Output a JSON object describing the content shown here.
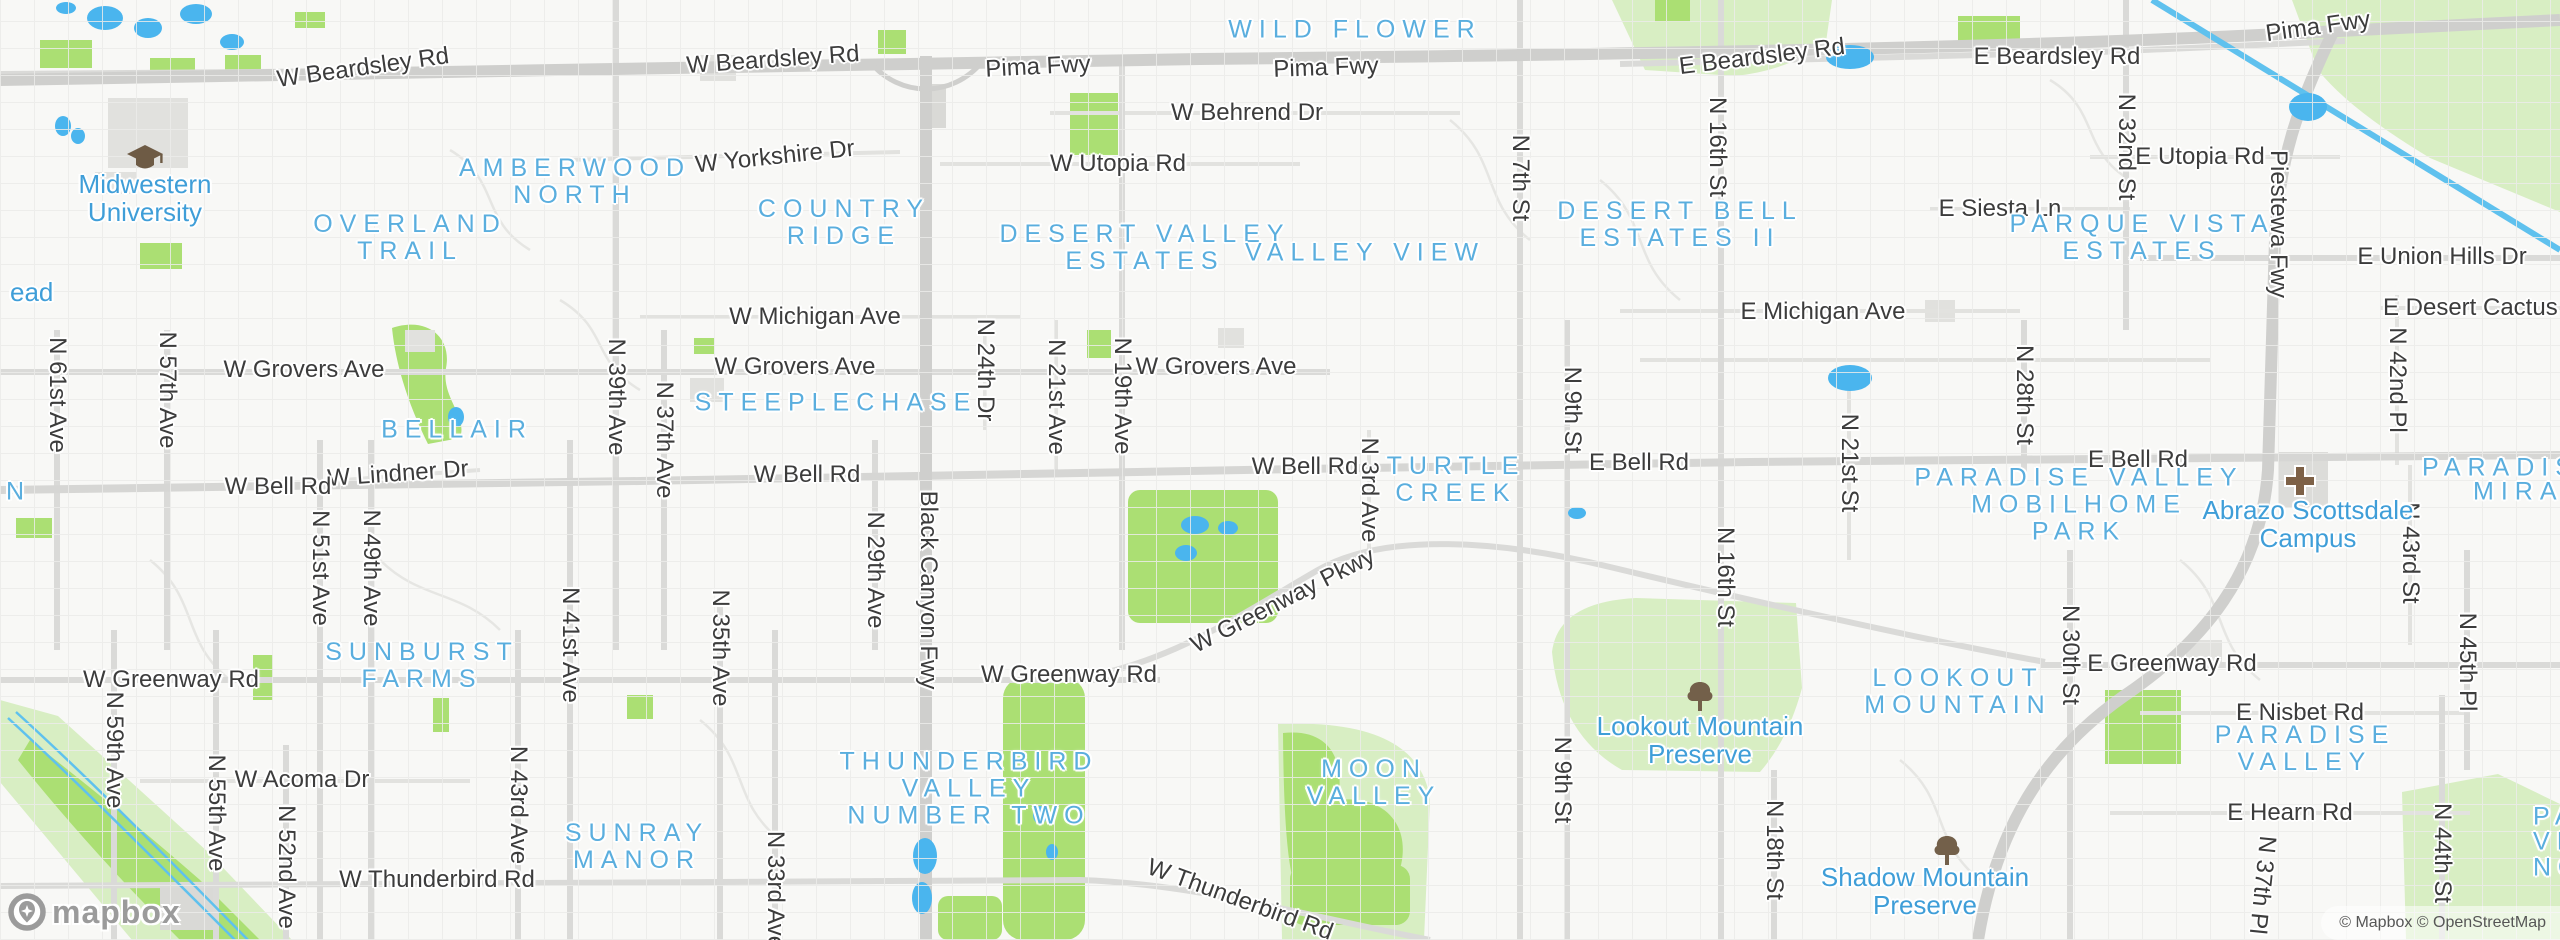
{
  "palette": {
    "land": "#f8f8f6",
    "park_bright": "#abdf73",
    "park_light": "#d8eec3",
    "water": "#4ab5ee",
    "canal": "#5fc1ee",
    "road_minor": "#e6e6e3",
    "road_arterial": "#dadad8",
    "road_freeway": "#cfcfcd",
    "building": "#e1e1de",
    "street_label": "#3c3c3c",
    "neighborhood_label": "#5aaede",
    "poi_label": "#3f9ed8",
    "icon_brown": "#73604a",
    "logo_gray": "#9b9b9b"
  },
  "street_labels": [
    {
      "text": "W Beardsley Rd",
      "x": 363,
      "y": 68,
      "rot": -8
    },
    {
      "text": "W Beardsley Rd",
      "x": 773,
      "y": 60,
      "rot": -4
    },
    {
      "text": "Pima Fwy",
      "x": 1038,
      "y": 67,
      "rot": -3
    },
    {
      "text": "Pima Fwy",
      "x": 1326,
      "y": 68,
      "rot": -2
    },
    {
      "text": "Pima Fwy",
      "x": 2318,
      "y": 27,
      "rot": -8
    },
    {
      "text": "E Beardsley Rd",
      "x": 1762,
      "y": 57,
      "rot": -7
    },
    {
      "text": "E Beardsley Rd",
      "x": 2057,
      "y": 57,
      "rot": 0
    },
    {
      "text": "W Behrend Dr",
      "x": 1247,
      "y": 113,
      "rot": 0
    },
    {
      "text": "W Yorkshire Dr",
      "x": 775,
      "y": 157,
      "rot": -6
    },
    {
      "text": "W Utopia Rd",
      "x": 1118,
      "y": 164,
      "rot": 0
    },
    {
      "text": "E Utopia Rd",
      "x": 2200,
      "y": 157,
      "rot": 0
    },
    {
      "text": "E Siesta Ln",
      "x": 2000,
      "y": 209,
      "rot": 0
    },
    {
      "text": "E Union Hills Dr",
      "x": 2442,
      "y": 257,
      "rot": 0
    },
    {
      "text": "E Desert Cactus St",
      "x": 2485,
      "y": 308,
      "rot": 0
    },
    {
      "text": "W Michigan Ave",
      "x": 815,
      "y": 317,
      "rot": 0
    },
    {
      "text": "E Michigan Ave",
      "x": 1823,
      "y": 312,
      "rot": 0
    },
    {
      "text": "W Grovers Ave",
      "x": 304,
      "y": 370,
      "rot": 0
    },
    {
      "text": "W Grovers Ave",
      "x": 795,
      "y": 367,
      "rot": 0
    },
    {
      "text": "W Grovers Ave",
      "x": 1216,
      "y": 367,
      "rot": 0
    },
    {
      "text": "W Lindner Dr",
      "x": 398,
      "y": 474,
      "rot": -4
    },
    {
      "text": "W Bell Rd",
      "x": 278,
      "y": 487,
      "rot": 0
    },
    {
      "text": "W Bell Rd",
      "x": 807,
      "y": 475,
      "rot": 0
    },
    {
      "text": "W Bell Rd",
      "x": 1305,
      "y": 467,
      "rot": 0
    },
    {
      "text": "E Bell Rd",
      "x": 1639,
      "y": 463,
      "rot": 0
    },
    {
      "text": "E Bell Rd",
      "x": 2138,
      "y": 460,
      "rot": 0
    },
    {
      "text": "W Greenway Pkwy",
      "x": 1283,
      "y": 601,
      "rot": -27
    },
    {
      "text": "W Greenway Rd",
      "x": 171,
      "y": 680,
      "rot": 0
    },
    {
      "text": "W Greenway Rd",
      "x": 1069,
      "y": 675,
      "rot": 0
    },
    {
      "text": "E Greenway Rd",
      "x": 2172,
      "y": 664,
      "rot": 0
    },
    {
      "text": "E Nisbet Rd",
      "x": 2300,
      "y": 713,
      "rot": 0
    },
    {
      "text": "W Acoma Dr",
      "x": 302,
      "y": 780,
      "rot": 0
    },
    {
      "text": "E Hearn Rd",
      "x": 2290,
      "y": 813,
      "rot": 0
    },
    {
      "text": "W Thunderbird Rd",
      "x": 437,
      "y": 880,
      "rot": 0
    },
    {
      "text": "W Thunderbird Rd",
      "x": 1240,
      "y": 900,
      "rot": 20
    }
  ],
  "vertical_street_labels": [
    {
      "text": "N 61st Ave",
      "x": 57,
      "y": 395
    },
    {
      "text": "N 57th Ave",
      "x": 167,
      "y": 390
    },
    {
      "text": "N 59th Ave",
      "x": 114,
      "y": 750
    },
    {
      "text": "N 55th Ave",
      "x": 216,
      "y": 813
    },
    {
      "text": "N 52nd Ave",
      "x": 286,
      "y": 867
    },
    {
      "text": "N 51st Ave",
      "x": 320,
      "y": 568
    },
    {
      "text": "N 49th Ave",
      "x": 371,
      "y": 568
    },
    {
      "text": "N 43rd Ave",
      "x": 518,
      "y": 805
    },
    {
      "text": "N 41st Ave",
      "x": 570,
      "y": 645
    },
    {
      "text": "N 39th Ave",
      "x": 616,
      "y": 397
    },
    {
      "text": "N 37th Ave",
      "x": 664,
      "y": 440
    },
    {
      "text": "N 35th Ave",
      "x": 720,
      "y": 648
    },
    {
      "text": "N 33rd Ave",
      "x": 775,
      "y": 890
    },
    {
      "text": "N 29th Ave",
      "x": 875,
      "y": 570
    },
    {
      "text": "Black Canyon Fwy",
      "x": 928,
      "y": 590
    },
    {
      "text": "N 24th Dr",
      "x": 985,
      "y": 370
    },
    {
      "text": "N 21st Ave",
      "x": 1056,
      "y": 397
    },
    {
      "text": "N 19th Ave",
      "x": 1122,
      "y": 396
    },
    {
      "text": "N 3rd Ave",
      "x": 1369,
      "y": 490
    },
    {
      "text": "N 7th St",
      "x": 1520,
      "y": 178
    },
    {
      "text": "N 9th St",
      "x": 1572,
      "y": 410
    },
    {
      "text": "N 9th St",
      "x": 1562,
      "y": 780
    },
    {
      "text": "N 16th St",
      "x": 1717,
      "y": 147
    },
    {
      "text": "N 16th St",
      "x": 1725,
      "y": 577
    },
    {
      "text": "N 18th St",
      "x": 1774,
      "y": 850
    },
    {
      "text": "N 21st St",
      "x": 1849,
      "y": 463
    },
    {
      "text": "N 28th St",
      "x": 2024,
      "y": 395
    },
    {
      "text": "N 30th St",
      "x": 2070,
      "y": 655
    },
    {
      "text": "N 32nd St",
      "x": 2126,
      "y": 147
    },
    {
      "text": "Piestewa Fwy",
      "x": 2278,
      "y": 224
    },
    {
      "text": "N 37th Pl",
      "x": 2262,
      "y": 885,
      "rot": 96
    },
    {
      "text": "N 42nd Pl",
      "x": 2397,
      "y": 380
    },
    {
      "text": "N 43rd St",
      "x": 2410,
      "y": 553
    },
    {
      "text": "N 44th St",
      "x": 2442,
      "y": 853
    },
    {
      "text": "N 45th Pl",
      "x": 2467,
      "y": 662
    }
  ],
  "neighborhood_labels": [
    {
      "lines": [
        "AMBERWOOD",
        "NORTH"
      ],
      "x": 575,
      "y": 182
    },
    {
      "lines": [
        "OVERLAND",
        "TRAIL"
      ],
      "x": 410,
      "y": 238
    },
    {
      "lines": [
        "COUNTRY",
        "RIDGE"
      ],
      "x": 844,
      "y": 223
    },
    {
      "lines": [
        "DESERT VALLEY",
        "ESTATES"
      ],
      "x": 1145,
      "y": 248
    },
    {
      "lines": [
        "VALLEY VIEW"
      ],
      "x": 1365,
      "y": 253
    },
    {
      "lines": [
        "WILD FLOWER"
      ],
      "x": 1355,
      "y": 30
    },
    {
      "lines": [
        "DESERT BELL",
        "ESTATES II"
      ],
      "x": 1680,
      "y": 225
    },
    {
      "lines": [
        "PARQUE VISTA",
        "ESTATES"
      ],
      "x": 2142,
      "y": 238
    },
    {
      "lines": [
        "BELLAIR"
      ],
      "x": 457,
      "y": 430
    },
    {
      "lines": [
        "STEEPLECHASE"
      ],
      "x": 836,
      "y": 403
    },
    {
      "lines": [
        "TURTLE",
        "CREEK"
      ],
      "x": 1456,
      "y": 480
    },
    {
      "lines": [
        "SUNBURST",
        "FARMS"
      ],
      "x": 422,
      "y": 666
    },
    {
      "lines": [
        "SUNRAY",
        "MANOR"
      ],
      "x": 637,
      "y": 847
    },
    {
      "lines": [
        "THUNDERBIRD",
        "VALLEY",
        "NUMBER TWO"
      ],
      "x": 969,
      "y": 789
    },
    {
      "lines": [
        "MOON",
        "VALLEY"
      ],
      "x": 1374,
      "y": 783
    },
    {
      "lines": [
        "LOOKOUT",
        "MOUNTAIN"
      ],
      "x": 1958,
      "y": 692
    },
    {
      "lines": [
        "PARADISE VALLEY",
        "MOBILHOME",
        "PARK"
      ],
      "x": 2079,
      "y": 505
    },
    {
      "lines": [
        "PARADISE",
        "VALLEY"
      ],
      "x": 2305,
      "y": 749
    }
  ],
  "edge_cut_labels": [
    {
      "text": "PARADISE V",
      "x": 2422,
      "y": 468,
      "style": "hood"
    },
    {
      "text": "MIRAN",
      "x": 2473,
      "y": 492,
      "style": "hood"
    },
    {
      "text": "PA",
      "x": 2533,
      "y": 817,
      "style": "hood"
    },
    {
      "text": "VI",
      "x": 2533,
      "y": 842,
      "style": "hood"
    },
    {
      "text": "NO",
      "x": 2533,
      "y": 868,
      "style": "hood"
    },
    {
      "text": "N",
      "x": 6,
      "y": 492,
      "style": "hood"
    },
    {
      "text": "ead",
      "x": 10,
      "y": 292,
      "style": "poi"
    }
  ],
  "poi_labels": [
    {
      "lines": [
        "Midwestern",
        "University"
      ],
      "x": 145,
      "y": 198,
      "icon": "graduation-cap-icon",
      "ix": 145,
      "iy": 159
    },
    {
      "lines": [
        "Lookout Mountain",
        "Preserve"
      ],
      "x": 1700,
      "y": 740,
      "icon": "tree-icon",
      "ix": 1700,
      "iy": 698
    },
    {
      "lines": [
        "Shadow Mountain",
        "Preserve"
      ],
      "x": 1925,
      "y": 891,
      "icon": "tree-icon",
      "ix": 1947,
      "iy": 852
    },
    {
      "lines": [
        "Abrazo Scottsdale",
        "Campus"
      ],
      "x": 2308,
      "y": 524,
      "icon": "hospital-cross-icon",
      "ix": 2300,
      "iy": 481
    }
  ],
  "branding": {
    "logo_text": "mapbox"
  },
  "attribution": {
    "text": "© Mapbox © OpenStreetMap"
  }
}
